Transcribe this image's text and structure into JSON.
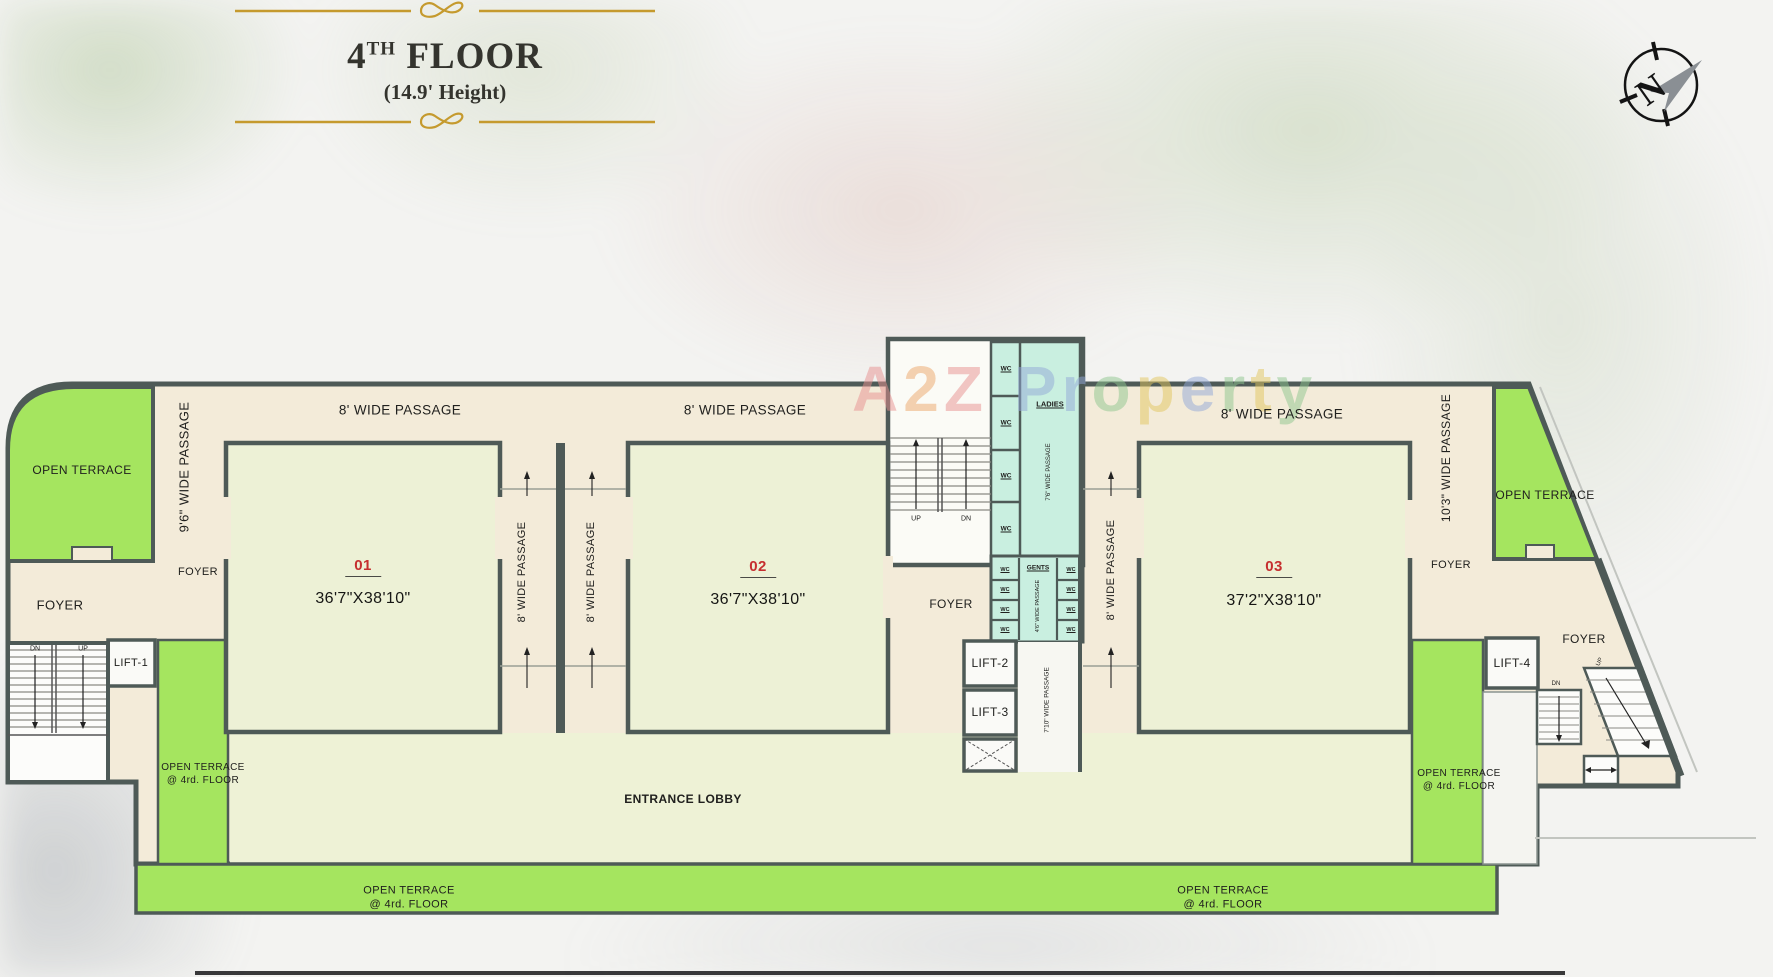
{
  "header": {
    "floor_number": "4",
    "floor_ordinal": "TH",
    "floor_word": "FLOOR",
    "height_note": "(14.9' Height)"
  },
  "compass": {
    "north": "N"
  },
  "watermark": {
    "letters": [
      {
        "ch": "A",
        "style": "color:#e89090"
      },
      {
        "ch": "2",
        "style": "color:#eda76b"
      },
      {
        "ch": "Z",
        "style": "color:#e89090"
      },
      {
        "ch": "P",
        "style": "color:#93a9d8"
      },
      {
        "ch": "r",
        "style": "color:#93a9d8"
      },
      {
        "ch": "o",
        "style": "color:#8fc78f"
      },
      {
        "ch": "p",
        "style": "color:#e2c75f"
      },
      {
        "ch": "e",
        "style": "color:#93a9d8"
      },
      {
        "ch": "r",
        "style": "color:#8fc78f"
      },
      {
        "ch": "t",
        "style": "color:#e2c75f"
      },
      {
        "ch": "y",
        "style": "color:#8fc78f"
      }
    ]
  },
  "plan": {
    "units": [
      {
        "number": "01",
        "dim": "36'7\"X38'10\""
      },
      {
        "number": "02",
        "dim": "36'7\"X38'10\""
      },
      {
        "number": "03",
        "dim": "37'2\"X38'10\""
      }
    ],
    "labels": {
      "open_terrace": "OPEN TERRACE",
      "terrace_line1": "OPEN TERRACE",
      "terrace_line2": "@ 4rd. FLOOR",
      "foyer": "FOYER",
      "passage_8": "8' WIDE PASSAGE",
      "passage_96": "9'6\" WIDE PASSAGE",
      "passage_103": "10'3\" WIDE PASSAGE",
      "passage_710": "7'10\" WIDE PASSAGE",
      "passage_76": "7'6\" WIDE PASSAGE",
      "passage_46": "4'6\" WIDE PASSAGE",
      "ladies": "LADIES",
      "gents": "GENTS",
      "wc": "WC",
      "up": "UP",
      "dn": "DN",
      "lift1": "LIFT-1",
      "lift2": "LIFT-2",
      "lift3": "LIFT-3",
      "lift4": "LIFT-4",
      "entrance_lobby": "ENTRANCE LOBBY"
    },
    "colors": {
      "walls": "#4e5a57",
      "terrace_green": "#a5e55f",
      "unit_fill": "#edf1d6",
      "passage_cream": "#f3ebd9",
      "toilet_teal": "#c9efe0",
      "lobby_fill": "#eef2d6",
      "unit_number_red": "#c62f2f",
      "ornament_gold": "#c59a2e"
    }
  }
}
